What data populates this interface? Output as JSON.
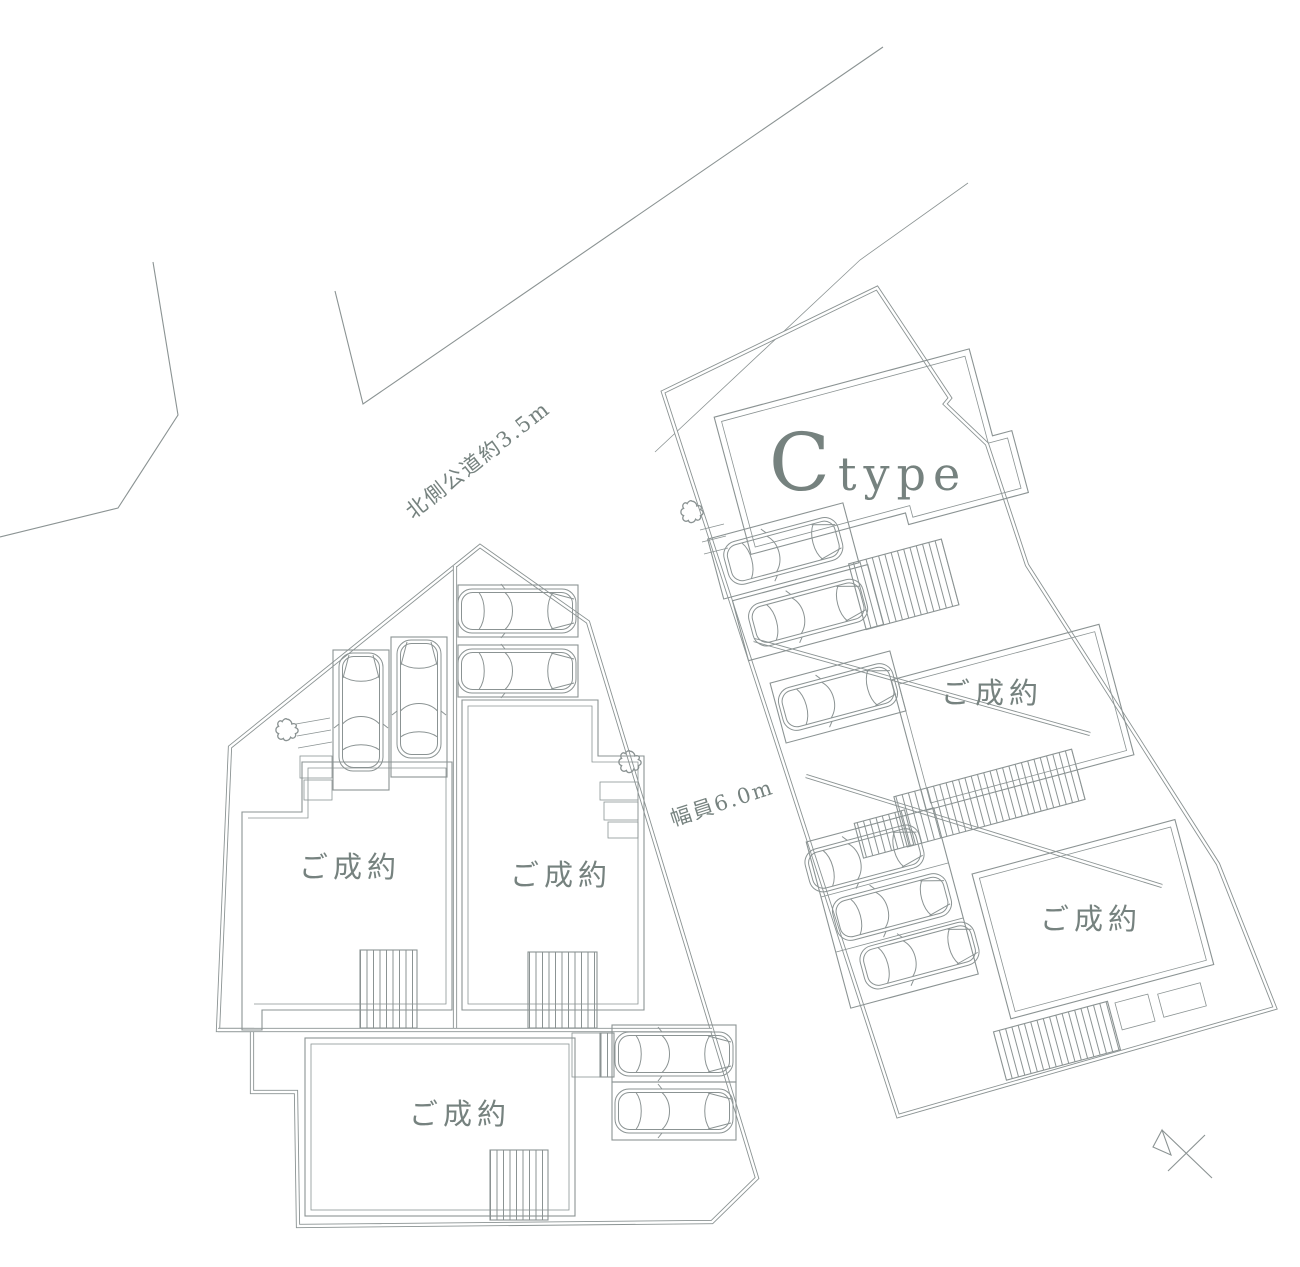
{
  "canvas": {
    "width": 1300,
    "height": 1267,
    "background_color": "#ffffff",
    "line_color": "#8b9393",
    "text_color": "#76827f"
  },
  "roads": {
    "north_road_label": "北側公道約3.5m",
    "center_road_label": "幅員6.0m"
  },
  "lots": {
    "c_type": {
      "label_large": "C",
      "label_small": "type"
    },
    "sold": [
      {
        "id": "lot-west",
        "status_label": "ご成約"
      },
      {
        "id": "lot-center",
        "status_label": "ご成約"
      },
      {
        "id": "lot-south",
        "status_label": "ご成約"
      },
      {
        "id": "lot-east-middle",
        "status_label": "ご成約"
      },
      {
        "id": "lot-east-south",
        "status_label": "ご成約"
      }
    ]
  }
}
